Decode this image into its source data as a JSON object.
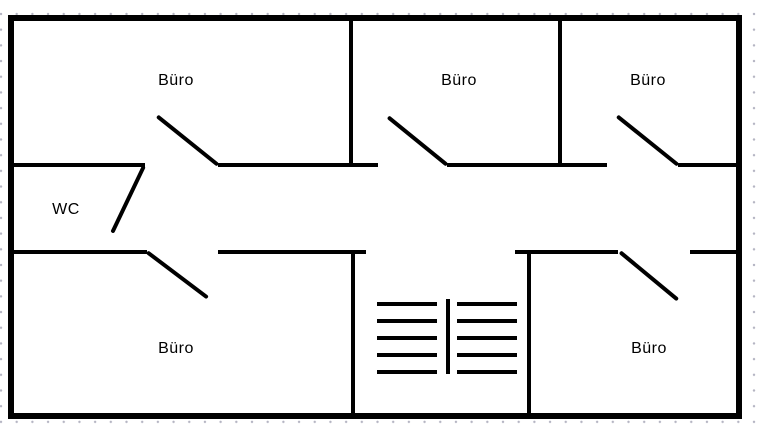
{
  "canvas": {
    "width": 758,
    "height": 424
  },
  "rooms": [
    {
      "id": "buero-top-left",
      "label": "Büro",
      "cx": 176,
      "cy": 81
    },
    {
      "id": "buero-top-middle",
      "label": "Büro",
      "cx": 459,
      "cy": 81
    },
    {
      "id": "buero-top-right",
      "label": "Büro",
      "cx": 648,
      "cy": 81
    },
    {
      "id": "wc",
      "label": "WC",
      "cx": 66,
      "cy": 210
    },
    {
      "id": "buero-bottom-left",
      "label": "Büro",
      "cx": 176,
      "cy": 349
    },
    {
      "id": "buero-bottom-right",
      "label": "Büro",
      "cx": 649,
      "cy": 349
    }
  ],
  "colors": {
    "wall": "#000000",
    "text": "#000000",
    "grid_dot": "#b4b4c2",
    "background": "#ffffff"
  },
  "geometry": {
    "plan_background": {
      "x": 8,
      "y": 15,
      "w": 734,
      "h": 404
    },
    "walls": [
      {
        "id": "outer-top",
        "x": 8,
        "y": 15,
        "w": 734,
        "h": 6
      },
      {
        "id": "outer-bottom",
        "x": 8,
        "y": 413,
        "w": 734,
        "h": 6
      },
      {
        "id": "outer-left",
        "x": 8,
        "y": 15,
        "w": 6,
        "h": 404
      },
      {
        "id": "outer-right",
        "x": 736,
        "y": 15,
        "w": 6,
        "h": 404
      },
      {
        "id": "corridor-top-west",
        "x": 8,
        "y": 163,
        "w": 137,
        "h": 4
      },
      {
        "id": "corridor-top-mid-left",
        "x": 218,
        "y": 163,
        "w": 160,
        "h": 4
      },
      {
        "id": "corridor-top-mid-right",
        "x": 447,
        "y": 163,
        "w": 160,
        "h": 4
      },
      {
        "id": "corridor-top-east",
        "x": 678,
        "y": 163,
        "w": 64,
        "h": 4
      },
      {
        "id": "corridor-bottom-west",
        "x": 8,
        "y": 250,
        "w": 139,
        "h": 4
      },
      {
        "id": "corridor-bottom-mid-left",
        "x": 218,
        "y": 250,
        "w": 148,
        "h": 4
      },
      {
        "id": "corridor-bottom-mid-right",
        "x": 515,
        "y": 250,
        "w": 103,
        "h": 4
      },
      {
        "id": "corridor-bottom-east",
        "x": 690,
        "y": 250,
        "w": 52,
        "h": 4
      },
      {
        "id": "divider-top-left",
        "x": 349,
        "y": 15,
        "w": 4,
        "h": 152
      },
      {
        "id": "divider-top-right",
        "x": 558,
        "y": 15,
        "w": 4,
        "h": 152
      },
      {
        "id": "stairwell-left",
        "x": 351,
        "y": 250,
        "w": 4,
        "h": 169
      },
      {
        "id": "stairwell-right",
        "x": 527,
        "y": 250,
        "w": 4,
        "h": 169
      }
    ],
    "doors": [
      {
        "id": "buero-top-left",
        "x1": 218,
        "y1": 165,
        "x2": 157,
        "y2": 116
      },
      {
        "id": "buero-top-middle",
        "x1": 447,
        "y1": 165,
        "x2": 388,
        "y2": 117
      },
      {
        "id": "buero-top-right",
        "x1": 678,
        "y1": 165,
        "x2": 617,
        "y2": 116
      },
      {
        "id": "wc",
        "x1": 144,
        "y1": 166,
        "x2": 112,
        "y2": 233
      },
      {
        "id": "buero-bottom-left",
        "x1": 147,
        "y1": 252,
        "x2": 208,
        "y2": 298
      },
      {
        "id": "buero-bottom-right",
        "x1": 620,
        "y1": 252,
        "x2": 678,
        "y2": 300
      }
    ],
    "stairs": {
      "left_flight": {
        "x": 377,
        "width": 60
      },
      "right_flight": {
        "x": 457,
        "width": 60
      },
      "step_ys": [
        302,
        319,
        336,
        353,
        370
      ],
      "step_thickness": 4,
      "divider": {
        "x": 446,
        "y": 299,
        "width": 4,
        "height": 75
      }
    }
  }
}
